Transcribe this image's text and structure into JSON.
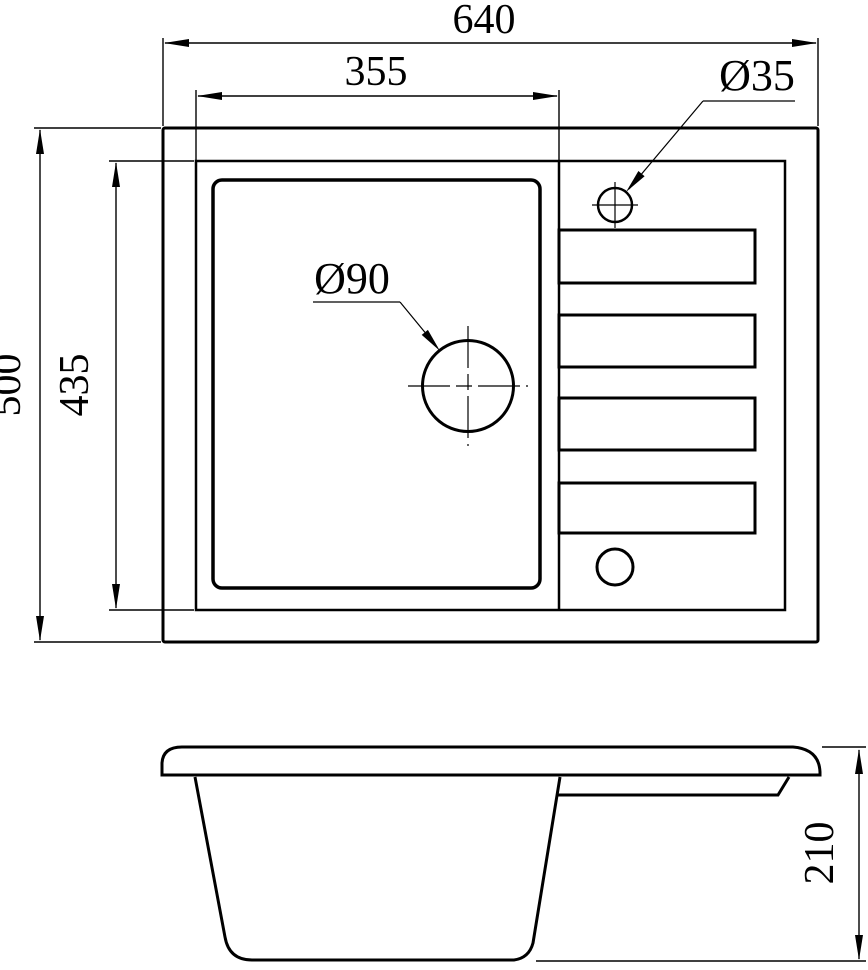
{
  "canvas": {
    "background": "#ffffff",
    "line_color": "#000000"
  },
  "top_view": {
    "dims": {
      "overall_width": "640",
      "bowl_width": "355",
      "overall_depth": "500",
      "inner_depth": "435"
    },
    "labels": {
      "faucet_hole": "Ø35",
      "drain_hole": "Ø90"
    }
  },
  "side_view": {
    "dims": {
      "height": "210"
    }
  }
}
